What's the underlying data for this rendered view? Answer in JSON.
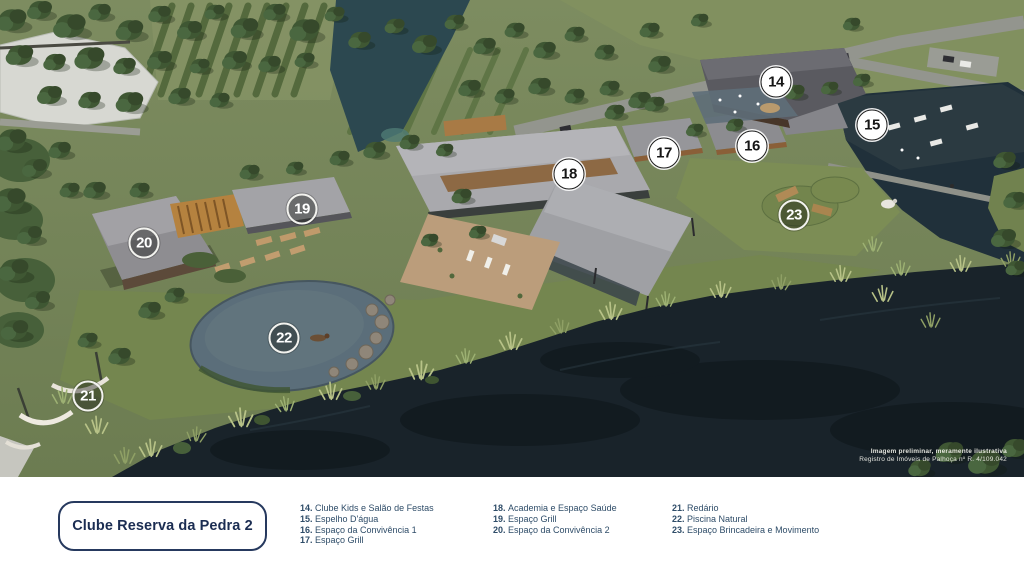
{
  "title_box": {
    "label": "Clube Reserva da Pedra 2"
  },
  "legend": {
    "columns": [
      {
        "items": [
          {
            "number": "14",
            "label": "Clube Kids e Salão de Festas"
          },
          {
            "number": "15",
            "label": "Espelho D'água"
          },
          {
            "number": "16",
            "label": "Espaço da Convivência 1"
          },
          {
            "number": "17",
            "label": "Espaço Grill"
          }
        ]
      },
      {
        "items": [
          {
            "number": "18",
            "label": "Academia e Espaço Saúde"
          },
          {
            "number": "19",
            "label": "Espaço Grill"
          },
          {
            "number": "20",
            "label": "Espaço da Convivência 2"
          }
        ]
      },
      {
        "items": [
          {
            "number": "21",
            "label": "Redário"
          },
          {
            "number": "22",
            "label": "Piscina Natural"
          },
          {
            "number": "23",
            "label": "Espaço Brincadeira e Movimento"
          }
        ]
      }
    ]
  },
  "markers": [
    {
      "number": "14",
      "x": 776,
      "y": 82,
      "variant": "light"
    },
    {
      "number": "15",
      "x": 872,
      "y": 125,
      "variant": "light"
    },
    {
      "number": "16",
      "x": 752,
      "y": 146,
      "variant": "light"
    },
    {
      "number": "17",
      "x": 664,
      "y": 153,
      "variant": "light"
    },
    {
      "number": "18",
      "x": 569,
      "y": 174,
      "variant": "light"
    },
    {
      "number": "19",
      "x": 302,
      "y": 209,
      "variant": "dark"
    },
    {
      "number": "20",
      "x": 144,
      "y": 243,
      "variant": "dark"
    },
    {
      "number": "21",
      "x": 88,
      "y": 396,
      "variant": "dark"
    },
    {
      "number": "22",
      "x": 284,
      "y": 338,
      "variant": "dark"
    },
    {
      "number": "23",
      "x": 794,
      "y": 215,
      "variant": "dark"
    }
  ],
  "disclaimer": {
    "line1": "Imagem preliminar, meramente ilustrativa",
    "line2": "Registro de Imóveis de Palhoça nº R. 4/109.042"
  },
  "colors": {
    "brand_navy": "#1b2d52",
    "legend_text": "#2e4c68",
    "marker_light_bg": "#ffffff",
    "marker_dark_ring": "#f2f2ee",
    "water_dark": "#19232a",
    "grass_olive": "#75855a",
    "roof_gray": "#a9a9ad"
  }
}
